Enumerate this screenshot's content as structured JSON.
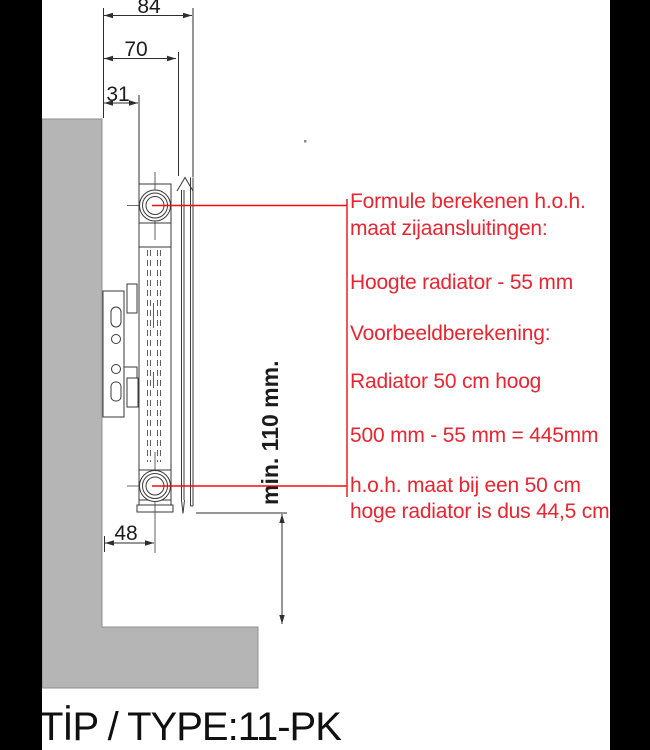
{
  "drawing": {
    "dim_84": "84",
    "dim_70": "70",
    "dim_31": "31",
    "dim_48": "48",
    "dim_min_height": "min. 110 mm."
  },
  "annotation": {
    "lines": [
      "Formule berekenen h.o.h.",
      "maat zijaansluitingen:",
      "Hoogte radiator - 55 mm",
      "Voorbeeldberekening:",
      "Radiator 50 cm hoog",
      "500 mm - 55 mm = 445mm",
      "h.o.h. maat bij een 50 cm",
      "hoge radiator is dus 44,5 cm"
    ]
  },
  "footer": {
    "type_label": "TİP / TYPE:11-PK"
  },
  "colors": {
    "wall_fill": "#b5b5b5",
    "drawing_line": "#3a3a3a",
    "red_leader_line": "#f20d0d",
    "red_text": "#ea2430",
    "scan_border": "#000000"
  }
}
